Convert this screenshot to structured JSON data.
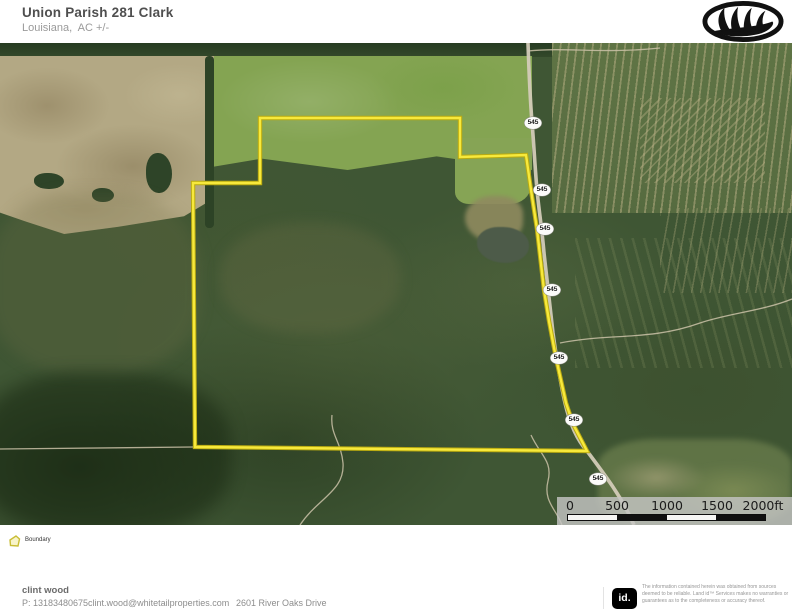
{
  "header": {
    "title": "Union Parish 281 Clark",
    "subtitle": "Louisiana,  AC +/-",
    "logo": "whitetail-antler-logo"
  },
  "map": {
    "route_shields": [
      "545",
      "545",
      "545",
      "545",
      "545",
      "545",
      "545"
    ],
    "scale_bar": {
      "tick_labels": [
        "0",
        "500",
        "1000",
        "1500",
        "2000ft"
      ]
    },
    "boundary_color": "#f7e93c"
  },
  "legend": {
    "boundary_label": "Boundary"
  },
  "footer": {
    "agent_name": "clint wood",
    "phone": "P: 13183480675",
    "email": "clint.wood@whitetailproperties.com",
    "address": "2601 River Oaks Drive",
    "logo_text": "id.",
    "disclaimer_line1": "The information contained herein was obtained from sources deemed to be reliable.",
    "disclaimer_line2": " Land id™ Services makes no warranties or guarantees as to the completeness or accuracy thereof."
  }
}
